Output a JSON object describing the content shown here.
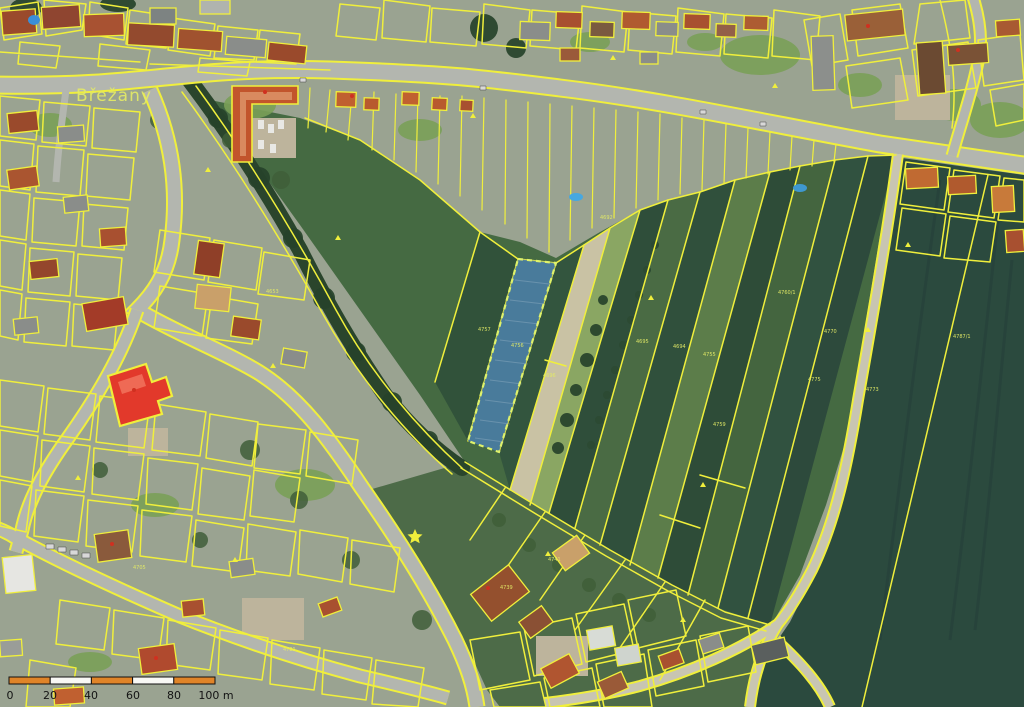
{
  "map": {
    "place_label": "Břežany",
    "colors": {
      "parcel_line": "#f0ef3c",
      "road_fill": "#b3b6af",
      "farm_road_fill": "#c8c5b2",
      "field_dark": "#2b4a3e",
      "field_medium": "#456a42",
      "field_light": "#8aa663",
      "field_beige": "#c9c2a4",
      "hedge_green": "#2a452c",
      "village_base": "#9aa391",
      "selection_blue": "#4b7fae",
      "selection_outline": "#dff26b",
      "highlight_red": "#e2392b",
      "label_yellow": "#e3ea66",
      "scalebar_orange": "#e08428",
      "scalebar_white": "#f8f8f4",
      "scalebar_text": "#141414"
    },
    "parcel_numbers": [
      {
        "text": "4757",
        "x": 478,
        "y": 331
      },
      {
        "text": "4756",
        "x": 511,
        "y": 347
      },
      {
        "text": "4696",
        "x": 543,
        "y": 377
      },
      {
        "text": "4692",
        "x": 600,
        "y": 219
      },
      {
        "text": "4695",
        "x": 636,
        "y": 343
      },
      {
        "text": "4694",
        "x": 673,
        "y": 348
      },
      {
        "text": "4755",
        "x": 703,
        "y": 356
      },
      {
        "text": "4760/1",
        "x": 778,
        "y": 294
      },
      {
        "text": "4770",
        "x": 824,
        "y": 333
      },
      {
        "text": "4775",
        "x": 808,
        "y": 381
      },
      {
        "text": "4773",
        "x": 866,
        "y": 391
      },
      {
        "text": "4787/1",
        "x": 953,
        "y": 338
      },
      {
        "text": "4759",
        "x": 713,
        "y": 426
      },
      {
        "text": "4741",
        "x": 548,
        "y": 561
      },
      {
        "text": "4739",
        "x": 500,
        "y": 589
      },
      {
        "text": "4721",
        "x": 283,
        "y": 651
      },
      {
        "text": "4705",
        "x": 133,
        "y": 569
      },
      {
        "text": "4653",
        "x": 266,
        "y": 293
      }
    ],
    "scale_bar": {
      "labels": [
        "0",
        "20",
        "40",
        "60",
        "80",
        "100 m"
      ]
    }
  }
}
